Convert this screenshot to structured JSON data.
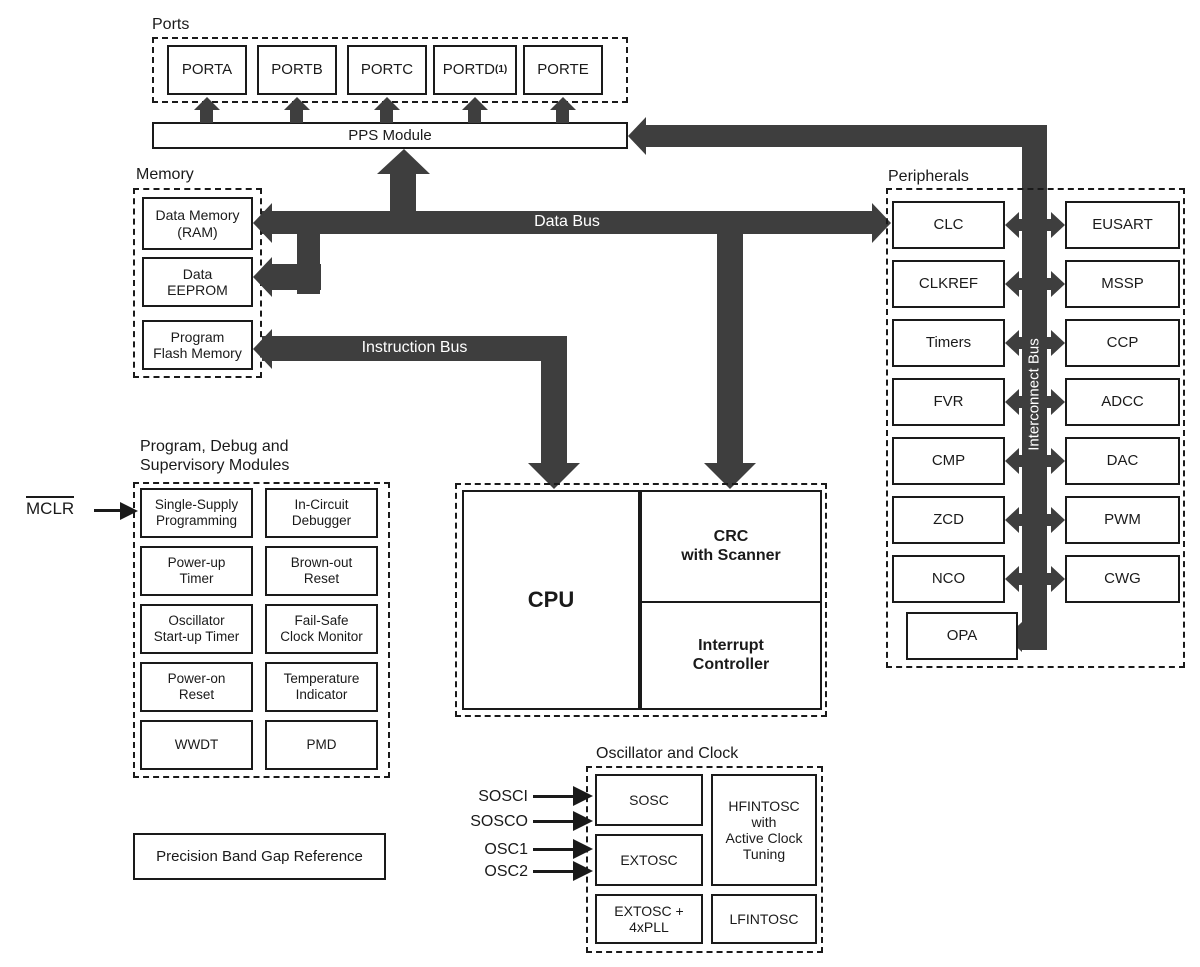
{
  "colors": {
    "bus": "#3e3e3e",
    "ink": "#1a1a1a"
  },
  "ports": {
    "label": "Ports",
    "items": [
      {
        "label": "PORTA",
        "note": ""
      },
      {
        "label": "PORTB",
        "note": ""
      },
      {
        "label": "PORTC",
        "note": ""
      },
      {
        "label": "PORTD",
        "note": "(1)"
      },
      {
        "label": "PORTE",
        "note": ""
      }
    ]
  },
  "pps": {
    "label": "PPS Module"
  },
  "memory": {
    "label": "Memory",
    "items": [
      "Data Memory\n(RAM)",
      "Data\nEEPROM",
      "Program\nFlash Memory"
    ]
  },
  "buses": {
    "data": "Data Bus",
    "instruction": "Instruction Bus",
    "interconnect": "Interconnect Bus"
  },
  "cpu": {
    "cpu": "CPU",
    "crc": "CRC\nwith Scanner",
    "interrupt": "Interrupt\nController"
  },
  "peripherals": {
    "label": "Peripherals",
    "left": [
      "CLC",
      "CLKREF",
      "Timers",
      "FVR",
      "CMP",
      "ZCD",
      "NCO"
    ],
    "right": [
      "EUSART",
      "MSSP",
      "CCP",
      "ADCC",
      "DAC",
      "PWM",
      "CWG"
    ],
    "opa": "OPA"
  },
  "debug": {
    "heading": "Program, Debug and\nSupervisory Modules",
    "items": [
      "Single-Supply\nProgramming",
      "In-Circuit\nDebugger",
      "Power-up\nTimer",
      "Brown-out\nReset",
      "Oscillator\nStart-up Timer",
      "Fail-Safe\nClock Monitor",
      "Power-on\nReset",
      "Temperature\nIndicator",
      "WWDT",
      "PMD"
    ]
  },
  "mclr": {
    "label": "MCLR"
  },
  "bandgap": {
    "label": "Precision Band Gap Reference"
  },
  "oscillator": {
    "label": "Oscillator and Clock",
    "boxes": {
      "sosc": "SOSC",
      "extosc": "EXTOSC",
      "extosc_pll": "EXTOSC +\n4xPLL",
      "hfintosc": "HFINTOSC\nwith\nActive Clock\nTuning",
      "lfintosc": "LFINTOSC"
    },
    "inputs": [
      "SOSCI",
      "SOSCO",
      "OSC1",
      "OSC2"
    ]
  }
}
